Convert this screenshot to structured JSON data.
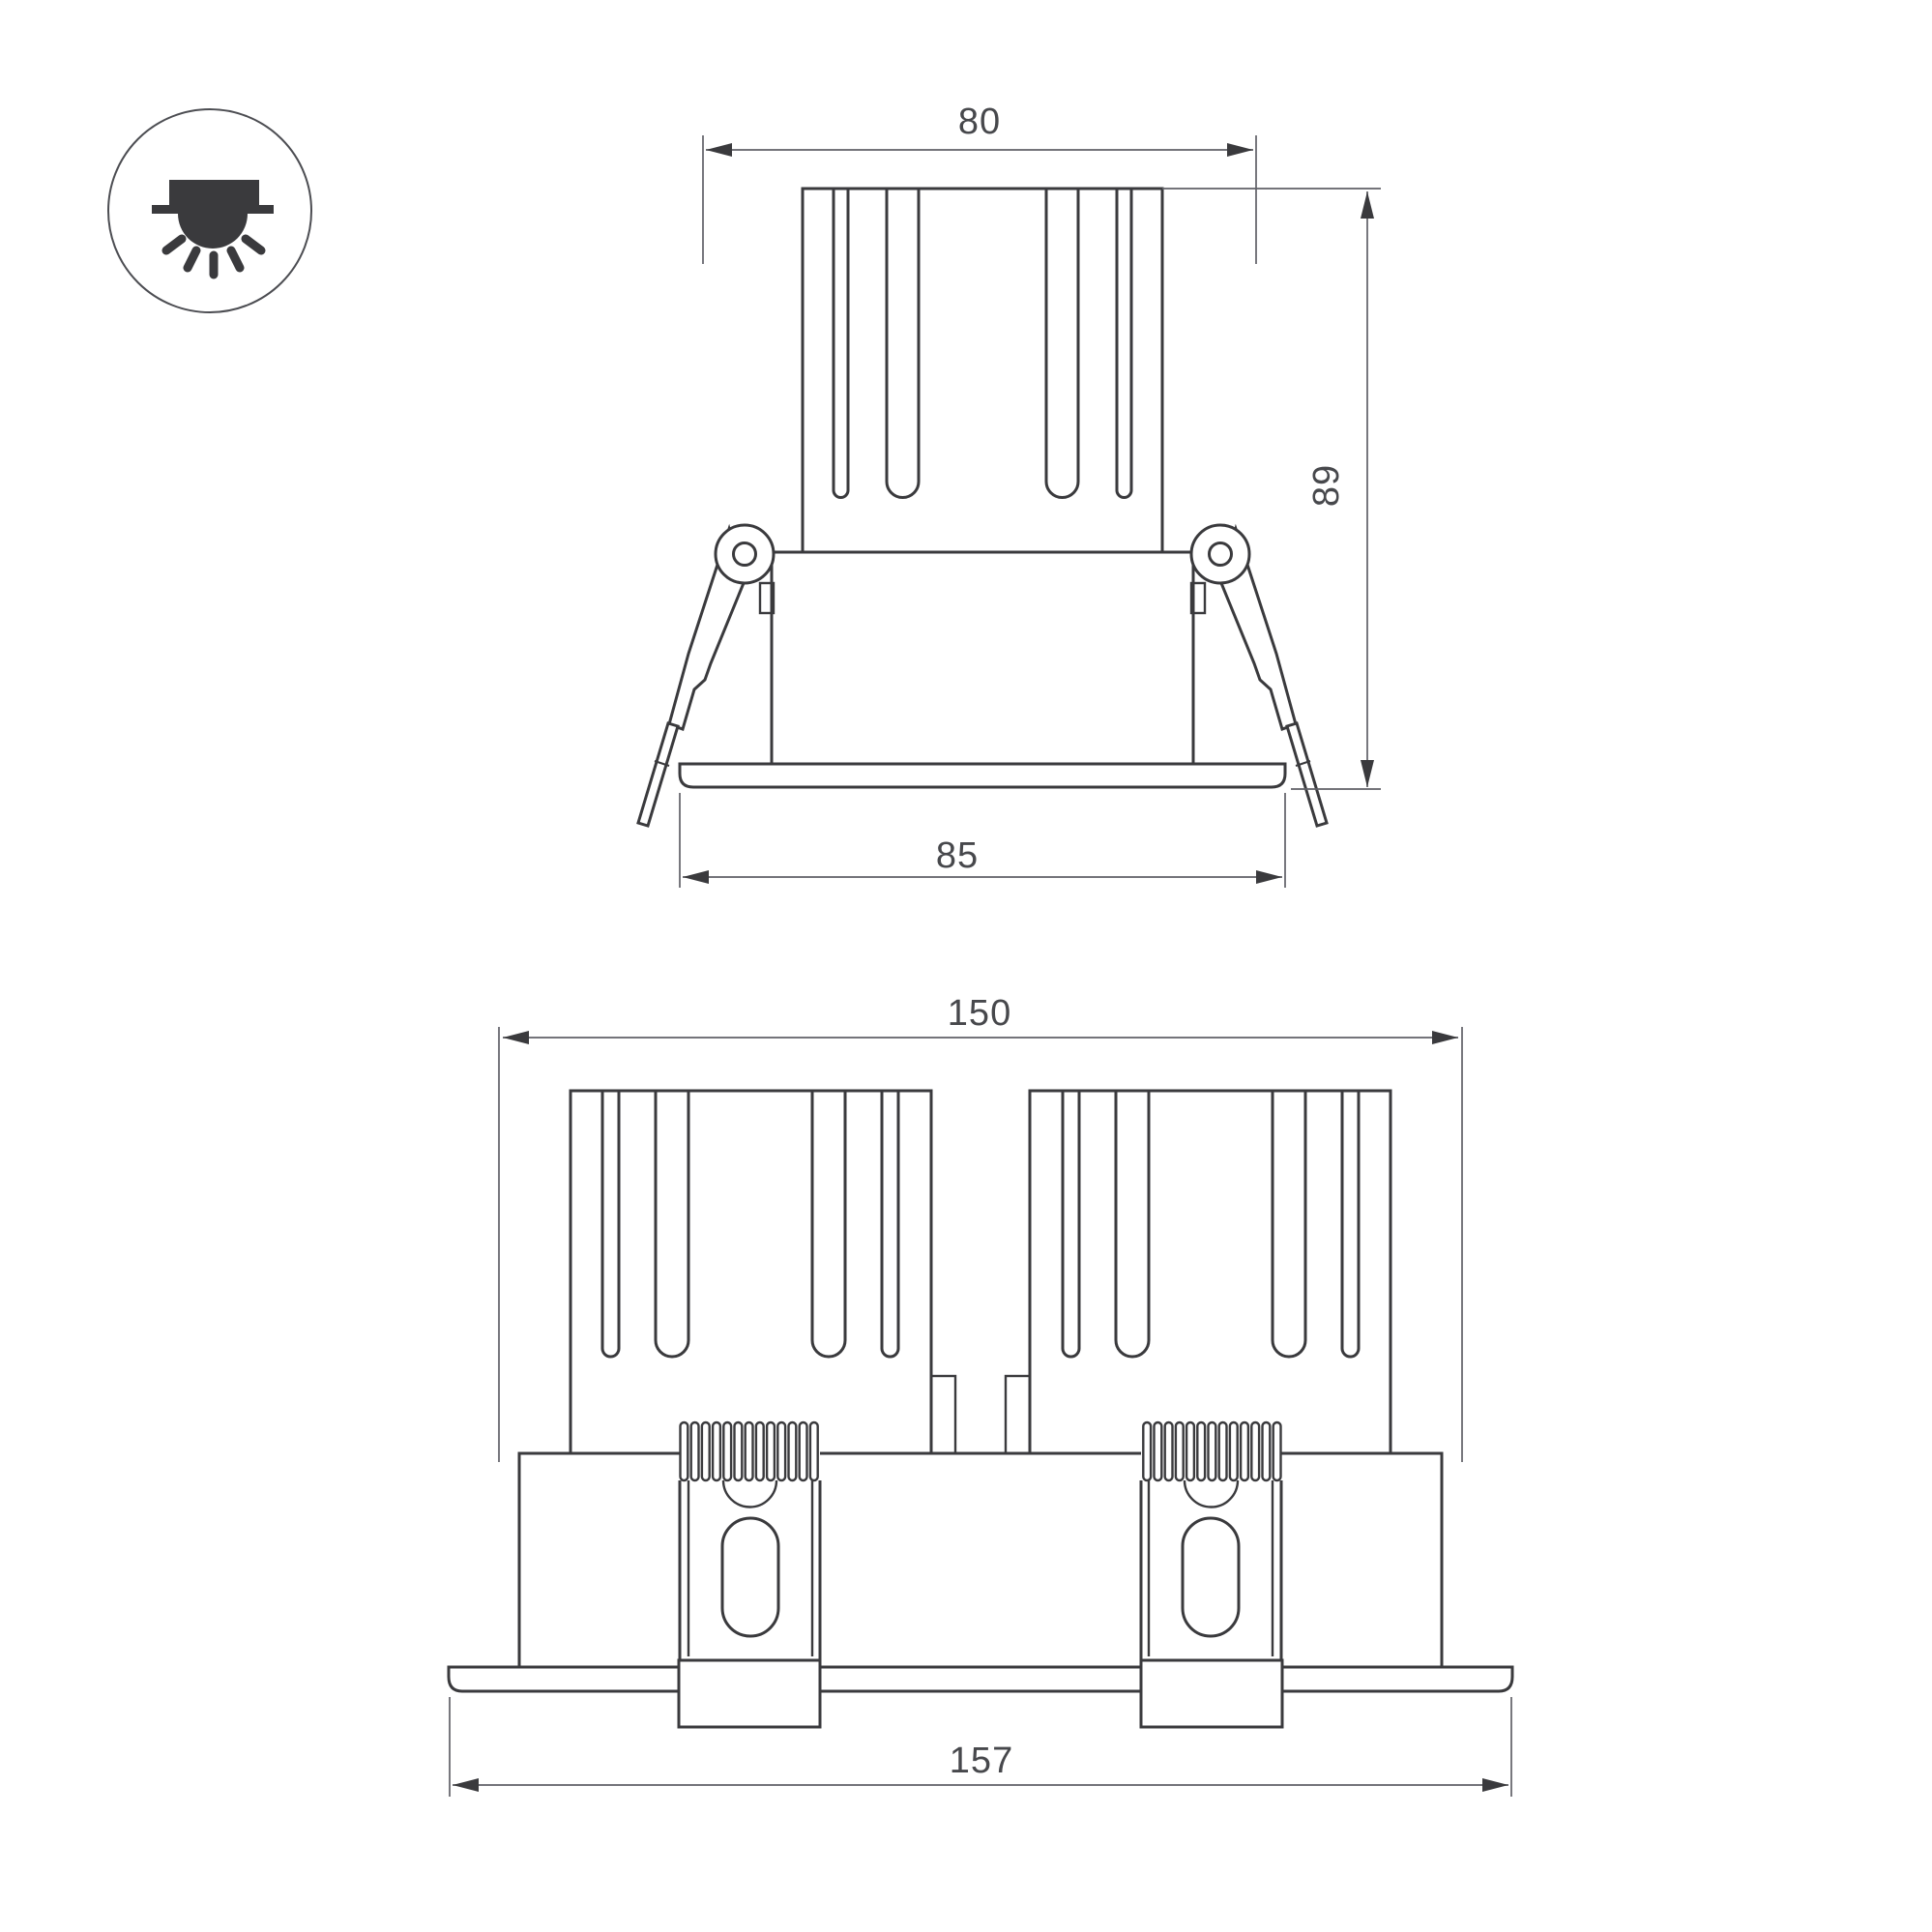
{
  "drawing": {
    "background": "#ffffff",
    "line_color": "#3a3a3d",
    "dimension_line_color": "#606167",
    "text_color": "#47484c",
    "icon": {
      "name": "recessed-downlight-icon"
    },
    "views": {
      "front_single": {
        "title": "single recessed downlight - front view",
        "dims": {
          "cutout_width": "80",
          "height": "89",
          "flange_width": "85"
        }
      },
      "front_double": {
        "title": "double recessed downlight - front view",
        "dims": {
          "cutout_width": "150",
          "flange_width": "157"
        }
      }
    }
  }
}
